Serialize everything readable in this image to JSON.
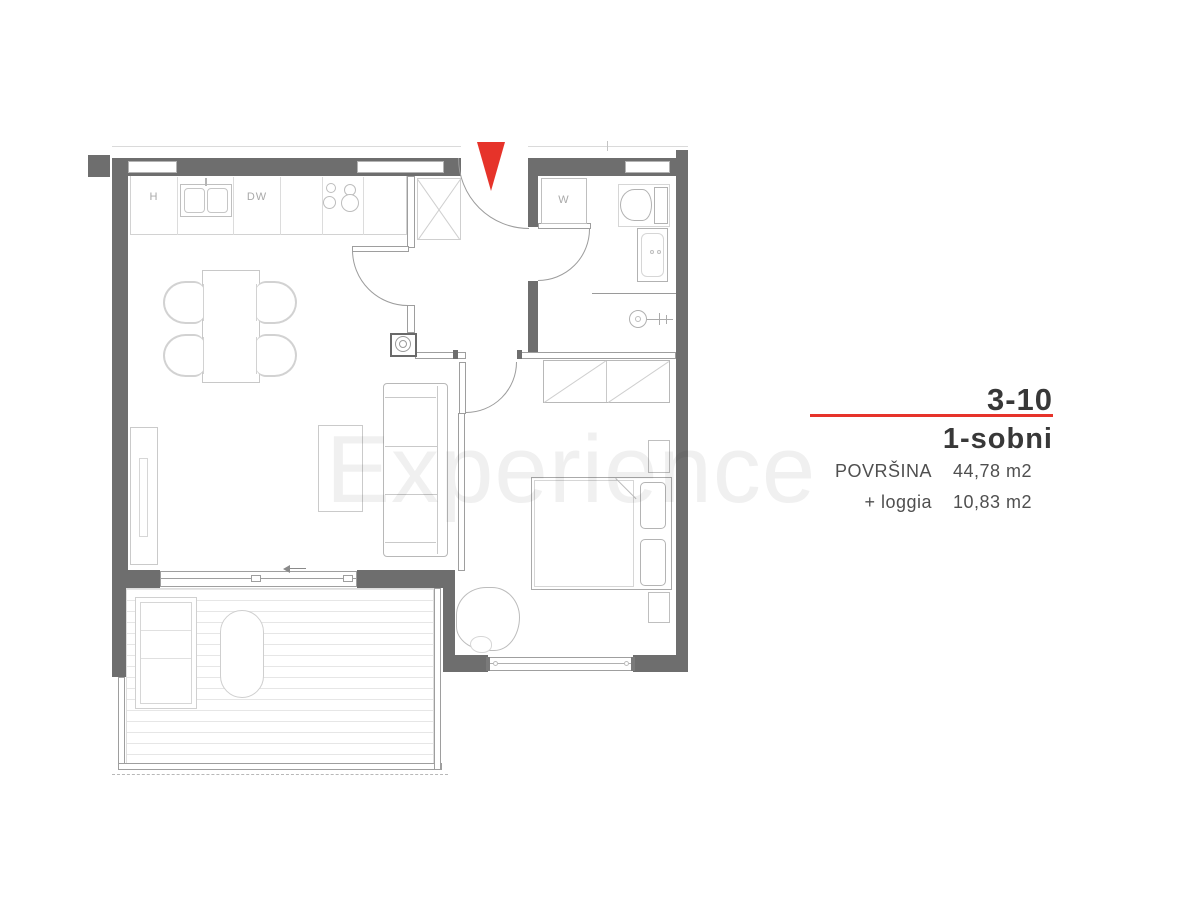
{
  "watermark_text": "Experience",
  "plan": {
    "wall_color": "#6e6e6e",
    "arrow_color": "#e6332a",
    "labels": {
      "fridge": "H",
      "dishwasher": "DW",
      "washer": "W"
    }
  },
  "info_panel": {
    "unit_code": "3-10",
    "unit_type": "1-sobni",
    "accent_color": "#e6332a",
    "rows": [
      {
        "label": "POVRŠINA",
        "value": "44,78 m2"
      },
      {
        "label": "+ loggia",
        "value": "10,83 m2"
      }
    ]
  }
}
